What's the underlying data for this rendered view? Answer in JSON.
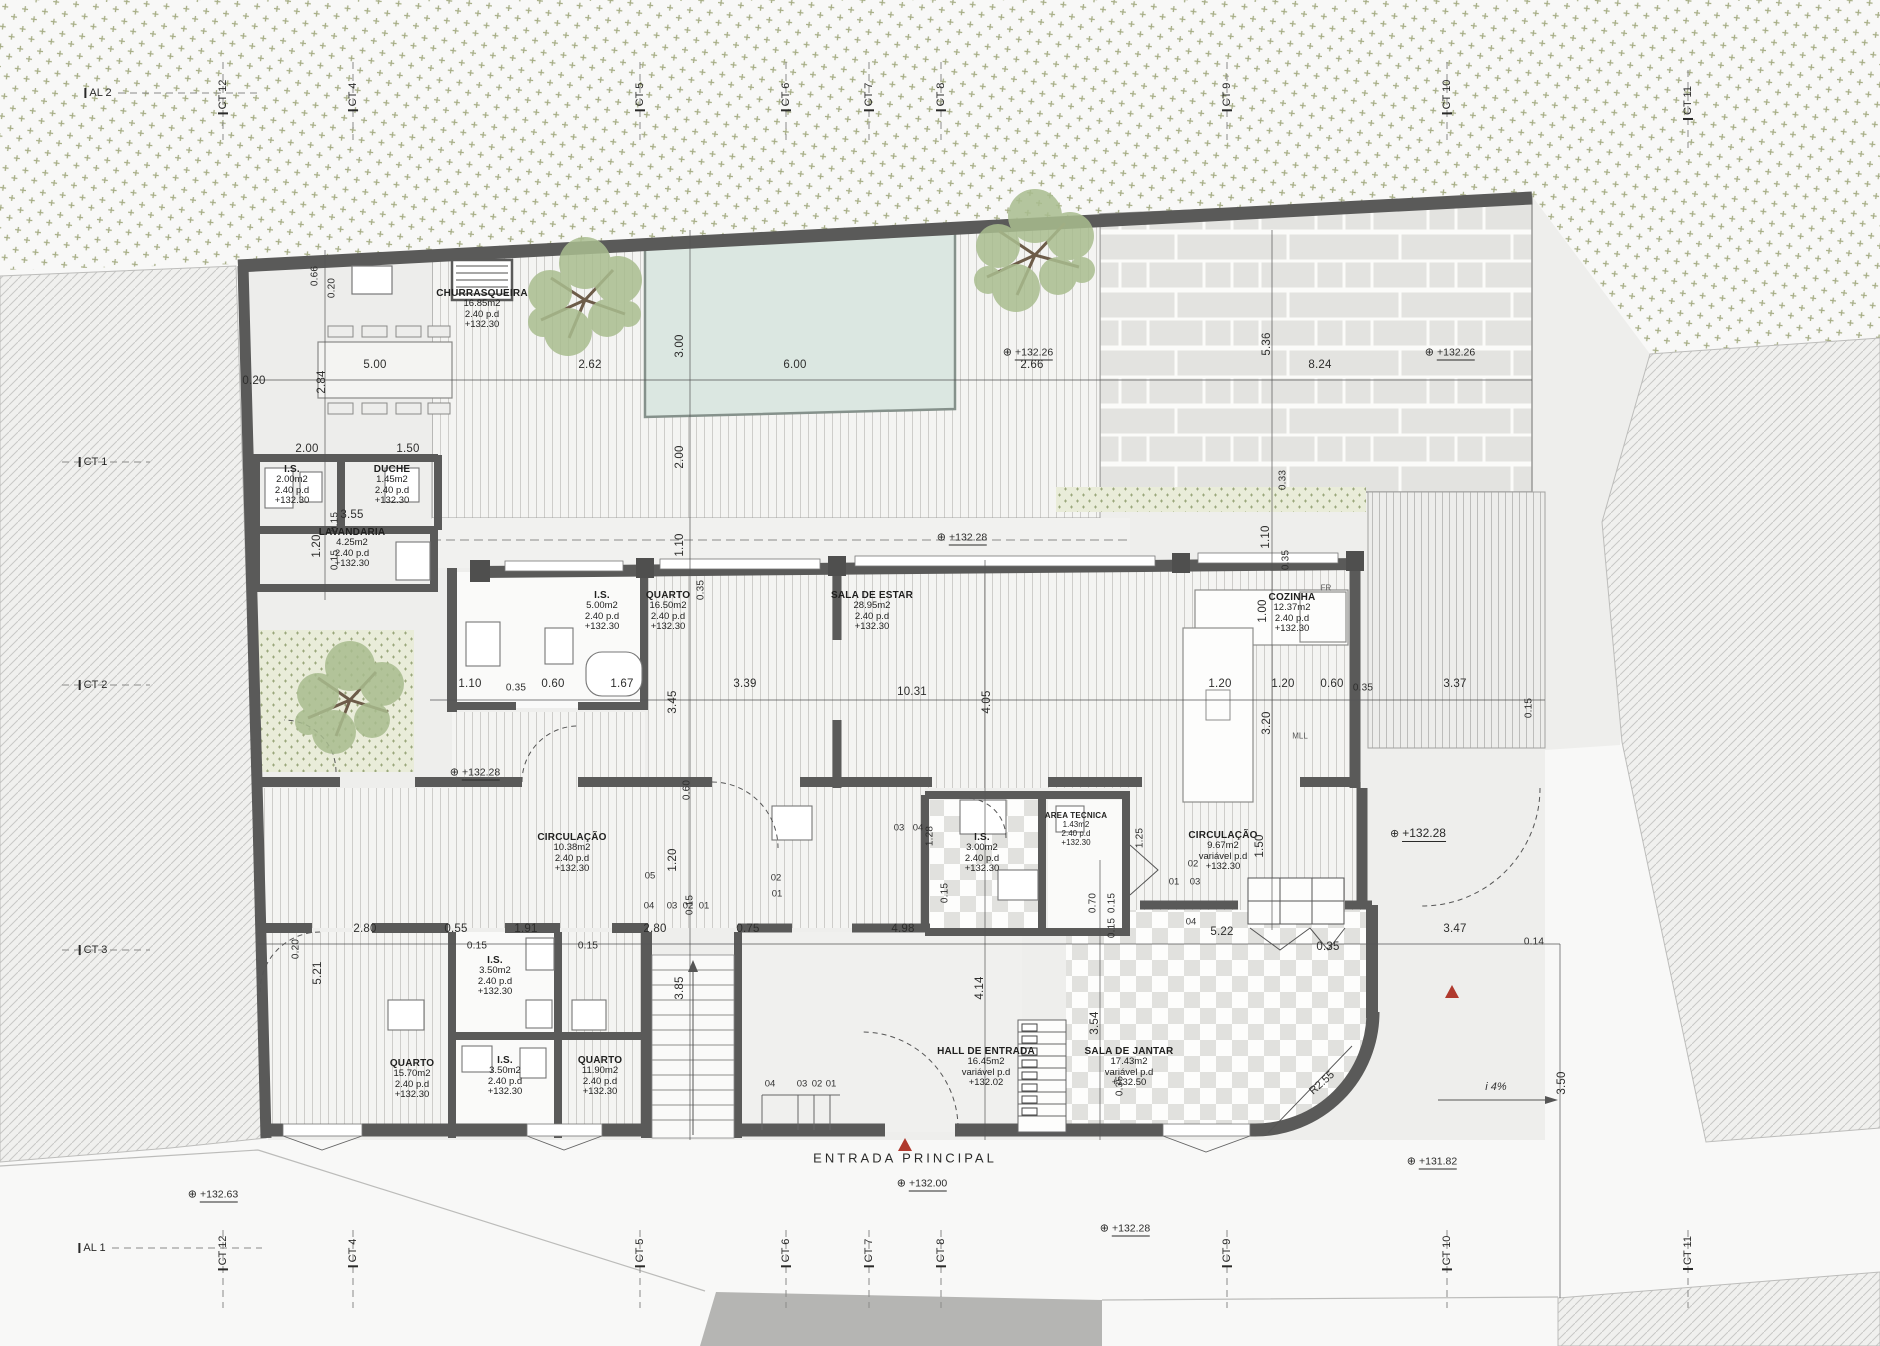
{
  "rooms": [
    {
      "name": "CHURRASQUEIRA",
      "area": "16.85m2",
      "height": "2.40  p.d",
      "level": "+132.30"
    },
    {
      "name": "I.S.",
      "area": "2.00m2",
      "height": "2.40  p.d",
      "level": "+132.30"
    },
    {
      "name": "DUCHE",
      "area": "1.45m2",
      "height": "2.40  p.d",
      "level": "+132.30"
    },
    {
      "name": "LAVANDARIA",
      "area": "4.25m2",
      "height": "2.40  p.d",
      "level": "+132.30"
    },
    {
      "name": "I.S.",
      "area": "5.00m2",
      "height": "2.40  p.d",
      "level": "+132.30"
    },
    {
      "name": "QUARTO",
      "area": "16.50m2",
      "height": "2.40  p.d",
      "level": "+132.30"
    },
    {
      "name": "SALA  DE  ESTAR",
      "area": "28.95m2",
      "height": "2.40  p.d",
      "level": "+132.30"
    },
    {
      "name": "COZINHA",
      "area": "12.37m2",
      "height": "2.40  p.d",
      "level": "+132.30"
    },
    {
      "name": "CIRCULAÇÃO",
      "area": "10.38m2",
      "height": "2.40  p.d",
      "level": "+132.30"
    },
    {
      "name": "I.S.",
      "area": "3.00m2",
      "height": "2.40  p.d",
      "level": "+132.30"
    },
    {
      "name": "AREA TECNICA",
      "area": "1.43m2",
      "height": "2.40  p.d",
      "level": "+132.30"
    },
    {
      "name": "CIRCULAÇÃO",
      "area": "9.67m2",
      "height": "variável  p.d",
      "level": "+132.30"
    },
    {
      "name": "QUARTO",
      "area": "15.70m2",
      "height": "2.40  p.d",
      "level": "+132.30"
    },
    {
      "name": "I.S.",
      "area": "3.50m2",
      "height": "2.40  p.d",
      "level": "+132.30"
    },
    {
      "name": "I.S.",
      "area": "3.50m2",
      "height": "2.40  p.d",
      "level": "+132.30"
    },
    {
      "name": "QUARTO",
      "area": "11.90m2",
      "height": "2.40  p.d",
      "level": "+132.30"
    },
    {
      "name": "HALL  DE  ENTRADA",
      "area": "16.45m2",
      "height": "variável  p.d",
      "level": "+132.02"
    },
    {
      "name": "SALA  DE  JANTAR",
      "area": "17.43m2",
      "height": "variável  p.d",
      "level": "+132.50"
    }
  ],
  "grid": {
    "top": [
      "AL 2",
      "CT 12",
      "CT 4",
      "CT 5",
      "CT 6",
      "CT 7",
      "CT 8",
      "CT 9",
      "CT 10",
      "CT 11"
    ],
    "bottom": [
      "AL 1",
      "CT 12",
      "CT 4",
      "CT 5",
      "CT 6",
      "CT 7",
      "CT 8",
      "CT 9",
      "CT 10",
      "CT 11"
    ],
    "left": [
      "CT 1",
      "CT 2",
      "CT 3"
    ]
  },
  "levels": [
    "+132.26",
    "+132.26",
    "+132.28",
    "+132.28",
    "+132.28",
    "+132.63",
    "+132.00",
    "+132.28",
    "+131.82"
  ],
  "dims": [
    "0.20",
    "5.00",
    "2.62",
    "6.00",
    "2.66",
    "8.24",
    "2.00",
    "1.50",
    "3.55",
    "1.10",
    "0.35",
    "0.60",
    "1.67",
    "3.39",
    "10.31",
    "1.20",
    "1.20",
    "0.60",
    "0.35",
    "3.37",
    "2.80",
    "0.55",
    "1.91",
    "0.15",
    "0.15",
    "2.80",
    "0.75",
    "4.98",
    "5.22",
    "0.35",
    "3.47",
    "0.14",
    "0.15",
    "0.66",
    "0.20",
    "2.84",
    "3.00",
    "5.36",
    "2.00",
    "1.10",
    "0.33",
    "1.10",
    "0.35",
    "1.00",
    "3.20",
    "0.35",
    "3.45",
    "4.05",
    "0.15",
    "0.60",
    "1.20",
    "0.15",
    "1.28",
    "0.15",
    "0.70",
    "0.15",
    "1.25",
    "1.50",
    "5.21",
    "0.20",
    "3.85",
    "4.14",
    "3.54",
    "0.35",
    "3.50",
    "0.15",
    "1.20",
    "0.15"
  ],
  "codes": {
    "flight": [
      "05",
      "04",
      "03",
      "02",
      "01"
    ],
    "entry": [
      "04",
      "03",
      "02",
      "01"
    ],
    "left": [
      "03",
      "04",
      "02",
      "01"
    ],
    "right": [
      "02",
      "01",
      "03",
      "04"
    ]
  },
  "annotations": {
    "entrance": "ENTRADA  PRINCIPAL",
    "slope": "i  4%",
    "radius": "R2.55",
    "fridge": "FR",
    "dishwasher": "MLL"
  },
  "colors": {
    "wall": "#5a5a59",
    "pool": "#dbe7e1",
    "foliage": "#a9bd8f",
    "accent_red": "#b03a2e",
    "paper": "#f8f8f7"
  }
}
